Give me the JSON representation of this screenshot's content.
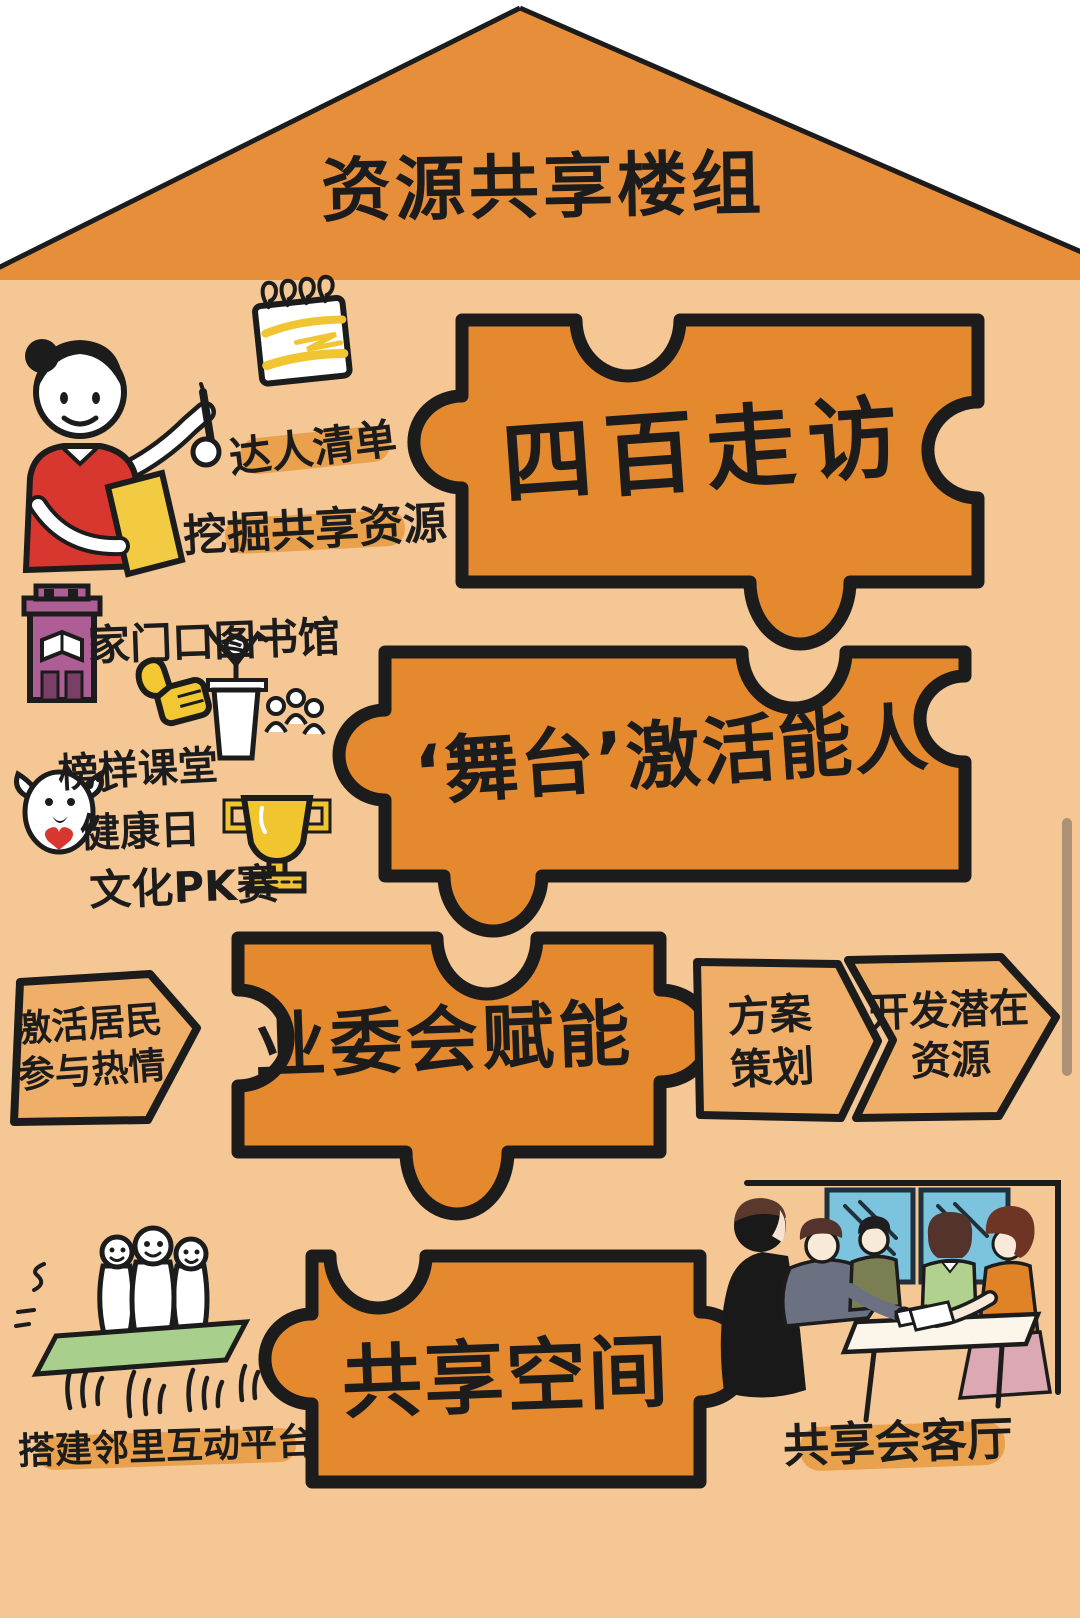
{
  "title": "资源共享楼组",
  "puzzles": [
    {
      "label": "四百走访"
    },
    {
      "label": "‘舞台’激活能人"
    },
    {
      "label": "业委会赋能"
    },
    {
      "label": "共享空间"
    }
  ],
  "arrows": {
    "left": {
      "line1": "激活居民",
      "line2": "参与热情"
    },
    "plan": {
      "line1": "方案",
      "line2": "策划"
    },
    "develop": {
      "line1": "开发潜在",
      "line2": "资源"
    }
  },
  "annotations": {
    "talent_list": "达人清单",
    "dig_resources": "挖掘共享资源",
    "library": "家门口图书馆",
    "model_class": "榜样课堂",
    "health_day": "健康日",
    "culture_pk": "文化PK赛",
    "platform": "搭建邻里互动平台",
    "reception": "共享会客厅"
  },
  "icons": {
    "woman": "woman-with-pen-and-clipboard",
    "notepad": "spiral-notepad",
    "library": "library-building",
    "thumbs_up": "thumbs-up",
    "podium": "speaker-at-podium-with-audience",
    "ghost": "happy-ghost-with-heart",
    "trophy": "trophy-cup",
    "platform_people": "three-figures-on-lifted-platform",
    "meeting": "people-meeting-at-table"
  },
  "colors": {
    "background": "#FFFFFF",
    "wall": "#F5C795",
    "roof": "#E78E3A",
    "puzzle": "#E5892E",
    "arrow": "#F0AF68",
    "highlight": "#E9A14D",
    "ink": "#1C1C1C",
    "scrollbar": "#A58B70",
    "window_blue": "#7CC3DD",
    "platform_green": "#A9CF8C",
    "building_purple": "#AD5E94",
    "accent_yellow": "#F1C52F",
    "shirt_red": "#D8372F"
  }
}
